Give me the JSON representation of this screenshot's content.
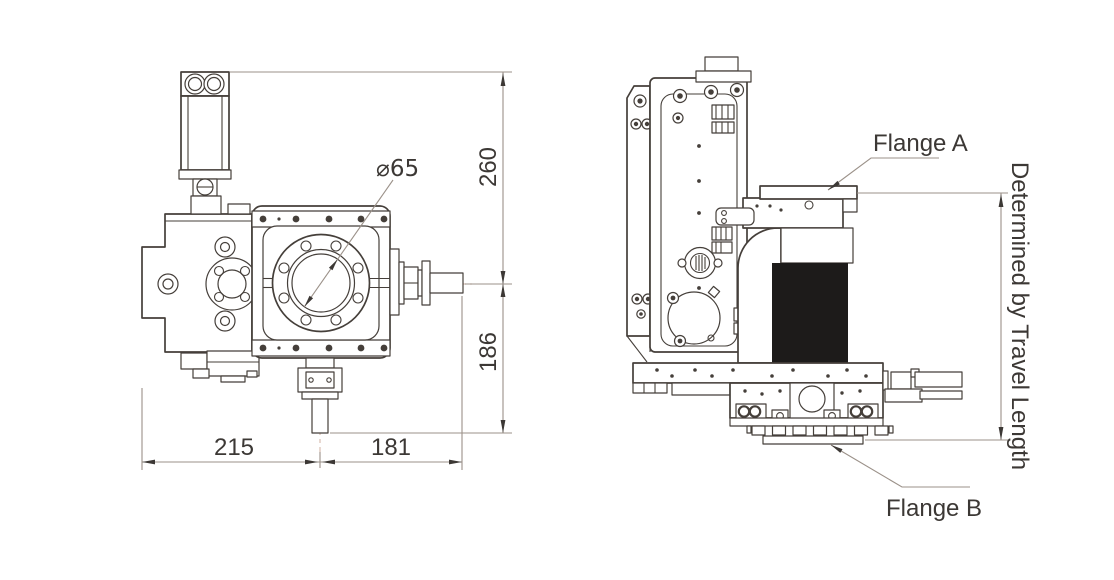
{
  "drawing": {
    "type": "technical-drawing",
    "front_view": {
      "bore_label": "⌀65",
      "dim_height_upper": "260",
      "dim_height_lower": "186",
      "dim_width_left": "215",
      "dim_width_right": "181"
    },
    "side_view": {
      "flange_a_label": "Flange A",
      "flange_b_label": "Flange B",
      "travel_note": "Determined by Travel Length"
    }
  },
  "colors": {
    "line": "#453f3a",
    "dim": "#9b9189",
    "centerline": "#d8beb2",
    "text": "#3c3835",
    "fill-dark": "#1d1b1a",
    "background": "#ffffff"
  }
}
